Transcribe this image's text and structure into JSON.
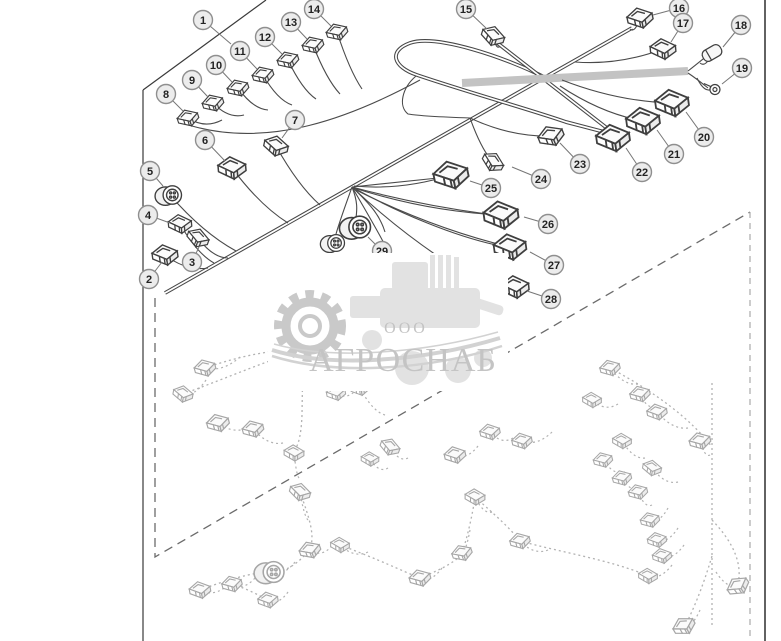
{
  "watermark": {
    "org_prefix": "ООО",
    "org_name": "АГРОСНАБ"
  },
  "colors": {
    "line_art": "#3f3f3f",
    "ghost_art": "#a6a6a6",
    "callout_fill": "#ececec",
    "callout_border": "#8f8f8f",
    "watermark_gray": "#c9c9c9",
    "background": "#ffffff"
  },
  "callouts": [
    {
      "n": "1",
      "x": 203,
      "y": 20,
      "tx": 231,
      "ty": 44
    },
    {
      "n": "2",
      "x": 149,
      "y": 279,
      "tx": 162,
      "ty": 262
    },
    {
      "n": "3",
      "x": 192,
      "y": 262,
      "tx": 199,
      "ty": 247
    },
    {
      "n": "4",
      "x": 148,
      "y": 215,
      "tx": 170,
      "ty": 223
    },
    {
      "n": "5",
      "x": 150,
      "y": 171,
      "tx": 163,
      "ty": 186
    },
    {
      "n": "6",
      "x": 205,
      "y": 140,
      "tx": 225,
      "ty": 161
    },
    {
      "n": "7",
      "x": 295,
      "y": 120,
      "tx": 282,
      "ty": 138
    },
    {
      "n": "8",
      "x": 166,
      "y": 94,
      "tx": 183,
      "ty": 111
    },
    {
      "n": "9",
      "x": 192,
      "y": 80,
      "tx": 208,
      "ty": 97
    },
    {
      "n": "10",
      "x": 216,
      "y": 65,
      "tx": 232,
      "ty": 82
    },
    {
      "n": "11",
      "x": 240,
      "y": 51,
      "tx": 257,
      "ty": 69
    },
    {
      "n": "12",
      "x": 265,
      "y": 37,
      "tx": 282,
      "ty": 54
    },
    {
      "n": "13",
      "x": 291,
      "y": 22,
      "tx": 307,
      "ty": 39
    },
    {
      "n": "14",
      "x": 314,
      "y": 9,
      "tx": 331,
      "ty": 26
    },
    {
      "n": "15",
      "x": 466,
      "y": 9,
      "tx": 487,
      "ty": 29
    },
    {
      "n": "16",
      "x": 679,
      "y": 8,
      "tx": 653,
      "ty": 15
    },
    {
      "n": "17",
      "x": 683,
      "y": 23,
      "tx": 671,
      "ty": 42
    },
    {
      "n": "18",
      "x": 741,
      "y": 25,
      "tx": 723,
      "ty": 47
    },
    {
      "n": "19",
      "x": 742,
      "y": 68,
      "tx": 722,
      "ty": 84
    },
    {
      "n": "20",
      "x": 704,
      "y": 137,
      "tx": 686,
      "ty": 112
    },
    {
      "n": "21",
      "x": 674,
      "y": 154,
      "tx": 657,
      "ty": 130
    },
    {
      "n": "22",
      "x": 642,
      "y": 172,
      "tx": 626,
      "ty": 148
    },
    {
      "n": "23",
      "x": 580,
      "y": 164,
      "tx": 560,
      "ty": 143
    },
    {
      "n": "24",
      "x": 541,
      "y": 179,
      "tx": 512,
      "ty": 167
    },
    {
      "n": "25",
      "x": 491,
      "y": 188,
      "tx": 470,
      "ty": 181
    },
    {
      "n": "26",
      "x": 548,
      "y": 224,
      "tx": 524,
      "ty": 217
    },
    {
      "n": "27",
      "x": 554,
      "y": 265,
      "tx": 530,
      "ty": 252
    },
    {
      "n": "28",
      "x": 551,
      "y": 299,
      "tx": 527,
      "ty": 291
    },
    {
      "n": "29",
      "x": 382,
      "y": 251,
      "tx": 368,
      "ty": 237
    }
  ],
  "main_connectors": [
    {
      "id": "2",
      "kind": "box",
      "x": 165,
      "y": 255,
      "r": -8,
      "s": 1.15,
      "wx": 208,
      "wy": 268
    },
    {
      "id": "3",
      "kind": "box",
      "x": 198,
      "y": 238,
      "r": 20,
      "s": 1.0,
      "wx": 228,
      "wy": 258
    },
    {
      "id": "4",
      "kind": "box",
      "x": 180,
      "y": 224,
      "r": -5,
      "s": 1.05,
      "wx": 214,
      "wy": 263
    },
    {
      "id": "5",
      "kind": "round",
      "x": 170,
      "y": 195,
      "r": 0,
      "s": 1.15,
      "wx": 236,
      "wy": 251
    },
    {
      "id": "6",
      "kind": "box",
      "x": 232,
      "y": 168,
      "r": -5,
      "s": 1.25,
      "wx": 288,
      "wy": 223
    },
    {
      "id": "7",
      "kind": "box",
      "x": 276,
      "y": 146,
      "r": 12,
      "s": 1.1,
      "wx": 320,
      "wy": 205
    },
    {
      "id": "8",
      "kind": "box",
      "x": 188,
      "y": 118,
      "r": -18,
      "s": 0.95,
      "wx": 222,
      "wy": 120
    },
    {
      "id": "9",
      "kind": "box",
      "x": 213,
      "y": 103,
      "r": -18,
      "s": 0.95,
      "wx": 244,
      "wy": 115
    },
    {
      "id": "10",
      "kind": "box",
      "x": 238,
      "y": 88,
      "r": -18,
      "s": 0.95,
      "wx": 268,
      "wy": 110
    },
    {
      "id": "11",
      "kind": "box",
      "x": 263,
      "y": 75,
      "r": -18,
      "s": 0.95,
      "wx": 292,
      "wy": 105
    },
    {
      "id": "12",
      "kind": "box",
      "x": 288,
      "y": 60,
      "r": -18,
      "s": 0.95,
      "wx": 316,
      "wy": 99
    },
    {
      "id": "13",
      "kind": "box",
      "x": 313,
      "y": 45,
      "r": -18,
      "s": 0.95,
      "wx": 340,
      "wy": 94
    },
    {
      "id": "14",
      "kind": "box",
      "x": 337,
      "y": 32,
      "r": -18,
      "s": 0.95,
      "wx": 362,
      "wy": 89
    },
    {
      "id": "15",
      "kind": "box",
      "x": 493,
      "y": 36,
      "r": 18,
      "s": 1.05,
      "wx": 500,
      "wy": 46
    },
    {
      "id": "16",
      "kind": "box",
      "x": 640,
      "y": 18,
      "r": -12,
      "s": 1.15,
      "wx": 630,
      "wy": 29
    },
    {
      "id": "17",
      "kind": "box",
      "x": 663,
      "y": 49,
      "r": -5,
      "s": 1.15,
      "wx": 575,
      "wy": 62
    },
    {
      "id": "18",
      "kind": "cyl",
      "x": 712,
      "y": 53,
      "r": -30,
      "s": 1.0,
      "wx": 700,
      "wy": 63
    },
    {
      "id": "19",
      "kind": "ring",
      "x": 712,
      "y": 89,
      "r": 10,
      "s": 1.0,
      "wx": 697,
      "wy": 78
    },
    {
      "id": "20",
      "kind": "box",
      "x": 672,
      "y": 103,
      "r": -8,
      "s": 1.5,
      "wx": 562,
      "wy": 80
    },
    {
      "id": "21",
      "kind": "box",
      "x": 643,
      "y": 121,
      "r": -8,
      "s": 1.5,
      "wx": 560,
      "wy": 86
    },
    {
      "id": "22",
      "kind": "box",
      "x": 613,
      "y": 138,
      "r": -8,
      "s": 1.5,
      "wx": 611,
      "wy": 133
    },
    {
      "id": "23",
      "kind": "box",
      "x": 551,
      "y": 136,
      "r": -22,
      "s": 1.15,
      "wx": 470,
      "wy": 118
    },
    {
      "id": "24",
      "kind": "box",
      "x": 493,
      "y": 162,
      "r": 28,
      "s": 1.0,
      "wx": 470,
      "wy": 118
    },
    {
      "id": "25",
      "kind": "box",
      "x": 451,
      "y": 175,
      "r": -12,
      "s": 1.55,
      "wx": 354,
      "wy": 186
    },
    {
      "id": "26",
      "kind": "box",
      "x": 501,
      "y": 215,
      "r": -8,
      "s": 1.55,
      "wx": 354,
      "wy": 188
    },
    {
      "id": "27",
      "kind": "box",
      "x": 510,
      "y": 247,
      "r": -8,
      "s": 1.45,
      "wx": 356,
      "wy": 190
    },
    {
      "id": "28",
      "kind": "box",
      "x": 515,
      "y": 287,
      "r": -5,
      "s": 1.25,
      "wx": 462,
      "wy": 272
    },
    {
      "id": "r1",
      "kind": "round",
      "x": 357,
      "y": 227,
      "r": 0,
      "s": 1.35,
      "wx": 356,
      "wy": 218
    },
    {
      "id": "r2",
      "kind": "round",
      "x": 334,
      "y": 243,
      "r": 0,
      "s": 1.05,
      "wx": 336,
      "wy": 234
    }
  ],
  "ghost_connectors": [
    {
      "id": "g1",
      "kind": "box",
      "x": 205,
      "y": 368,
      "r": -15,
      "s": 0.95,
      "wx": 240,
      "wy": 357
    },
    {
      "id": "g2",
      "kind": "box",
      "x": 183,
      "y": 394,
      "r": 10,
      "s": 0.9,
      "wx": 206,
      "wy": 380
    },
    {
      "id": "g3",
      "kind": "box",
      "x": 218,
      "y": 423,
      "r": -15,
      "s": 1.0,
      "wx": 250,
      "wy": 427
    },
    {
      "id": "g4",
      "kind": "box",
      "x": 253,
      "y": 429,
      "r": -15,
      "s": 0.95,
      "wx": 283,
      "wy": 443
    },
    {
      "id": "g5",
      "kind": "box",
      "x": 294,
      "y": 453,
      "r": 0,
      "s": 0.9,
      "wx": 299,
      "wy": 478
    },
    {
      "id": "g6",
      "kind": "box",
      "x": 300,
      "y": 492,
      "r": 15,
      "s": 0.95,
      "wx": 308,
      "wy": 520
    },
    {
      "id": "g7",
      "kind": "box",
      "x": 336,
      "y": 393,
      "r": -10,
      "s": 0.85,
      "wx": 357,
      "wy": 389
    },
    {
      "id": "g8",
      "kind": "box",
      "x": 360,
      "y": 388,
      "r": -10,
      "s": 0.85,
      "wx": 385,
      "wy": 415
    },
    {
      "id": "g9",
      "kind": "box",
      "x": 390,
      "y": 447,
      "r": 20,
      "s": 0.9,
      "wx": 408,
      "wy": 458
    },
    {
      "id": "g10",
      "kind": "box",
      "x": 370,
      "y": 459,
      "r": 0,
      "s": 0.8,
      "wx": 388,
      "wy": 468
    },
    {
      "id": "g11",
      "kind": "box",
      "x": 455,
      "y": 455,
      "r": -12,
      "s": 0.95,
      "wx": 478,
      "wy": 446
    },
    {
      "id": "g12",
      "kind": "box",
      "x": 490,
      "y": 432,
      "r": -12,
      "s": 0.9,
      "wx": 513,
      "wy": 438
    },
    {
      "id": "g13",
      "kind": "box",
      "x": 522,
      "y": 441,
      "r": -12,
      "s": 0.9,
      "wx": 552,
      "wy": 432
    },
    {
      "id": "g14",
      "kind": "box",
      "x": 610,
      "y": 368,
      "r": -15,
      "s": 0.9,
      "wx": 638,
      "wy": 384
    },
    {
      "id": "g15",
      "kind": "box",
      "x": 592,
      "y": 400,
      "r": 0,
      "s": 0.85,
      "wx": 618,
      "wy": 404
    },
    {
      "id": "g16",
      "kind": "box",
      "x": 640,
      "y": 394,
      "r": -15,
      "s": 0.9,
      "wx": 655,
      "wy": 406
    },
    {
      "id": "g17",
      "kind": "box",
      "x": 657,
      "y": 412,
      "r": -10,
      "s": 0.9,
      "wx": 688,
      "wy": 428
    },
    {
      "id": "g18",
      "kind": "box",
      "x": 700,
      "y": 441,
      "r": -15,
      "s": 0.95,
      "wx": 710,
      "wy": 455
    },
    {
      "id": "g19",
      "kind": "box",
      "x": 622,
      "y": 441,
      "r": 0,
      "s": 0.85,
      "wx": 645,
      "wy": 458
    },
    {
      "id": "g20",
      "kind": "box",
      "x": 652,
      "y": 468,
      "r": 10,
      "s": 0.85,
      "wx": 678,
      "wy": 482
    },
    {
      "id": "g21",
      "kind": "box",
      "x": 603,
      "y": 460,
      "r": -15,
      "s": 0.85,
      "wx": 625,
      "wy": 472
    },
    {
      "id": "g22",
      "kind": "box",
      "x": 622,
      "y": 478,
      "r": -15,
      "s": 0.85,
      "wx": 640,
      "wy": 488
    },
    {
      "id": "g23",
      "kind": "box",
      "x": 638,
      "y": 492,
      "r": -15,
      "s": 0.85,
      "wx": 652,
      "wy": 505
    },
    {
      "id": "g24",
      "kind": "box",
      "x": 650,
      "y": 520,
      "r": -15,
      "s": 0.85,
      "wx": 668,
      "wy": 508
    },
    {
      "id": "g25",
      "kind": "box",
      "x": 657,
      "y": 540,
      "r": -10,
      "s": 0.85,
      "wx": 678,
      "wy": 528
    },
    {
      "id": "g26",
      "kind": "box",
      "x": 662,
      "y": 556,
      "r": -10,
      "s": 0.85,
      "wx": 684,
      "wy": 545
    },
    {
      "id": "g27",
      "kind": "box",
      "x": 648,
      "y": 576,
      "r": 0,
      "s": 0.85,
      "wx": 672,
      "wy": 565
    },
    {
      "id": "g28",
      "kind": "box",
      "x": 738,
      "y": 586,
      "r": -35,
      "s": 1.0,
      "wx": 716,
      "wy": 572
    },
    {
      "id": "g29",
      "kind": "box",
      "x": 684,
      "y": 626,
      "r": -30,
      "s": 1.0,
      "wx": 700,
      "wy": 610
    },
    {
      "id": "g30",
      "kind": "box",
      "x": 200,
      "y": 590,
      "r": -10,
      "s": 0.95,
      "wx": 228,
      "wy": 585
    },
    {
      "id": "g31",
      "kind": "box",
      "x": 232,
      "y": 584,
      "r": -15,
      "s": 0.9,
      "wx": 255,
      "wy": 578
    },
    {
      "id": "g32",
      "kind": "box",
      "x": 268,
      "y": 600,
      "r": -10,
      "s": 0.9,
      "wx": 288,
      "wy": 592
    },
    {
      "id": "g33",
      "kind": "round",
      "x": 271,
      "y": 572,
      "r": 0,
      "s": 1.3,
      "wx": 295,
      "wy": 562
    },
    {
      "id": "g34",
      "kind": "box",
      "x": 310,
      "y": 550,
      "r": -20,
      "s": 0.95,
      "wx": 332,
      "wy": 546
    },
    {
      "id": "g35",
      "kind": "box",
      "x": 340,
      "y": 545,
      "r": 0,
      "s": 0.85,
      "wx": 368,
      "wy": 552
    },
    {
      "id": "g36",
      "kind": "box",
      "x": 420,
      "y": 578,
      "r": -15,
      "s": 0.95,
      "wx": 442,
      "wy": 568
    },
    {
      "id": "g37",
      "kind": "box",
      "x": 462,
      "y": 553,
      "r": -20,
      "s": 0.9,
      "wx": 470,
      "wy": 530
    },
    {
      "id": "g38",
      "kind": "box",
      "x": 475,
      "y": 497,
      "r": 0,
      "s": 0.9,
      "wx": 492,
      "wy": 512
    },
    {
      "id": "g39",
      "kind": "box",
      "x": 520,
      "y": 541,
      "r": -15,
      "s": 0.9,
      "wx": 548,
      "wy": 550
    }
  ]
}
